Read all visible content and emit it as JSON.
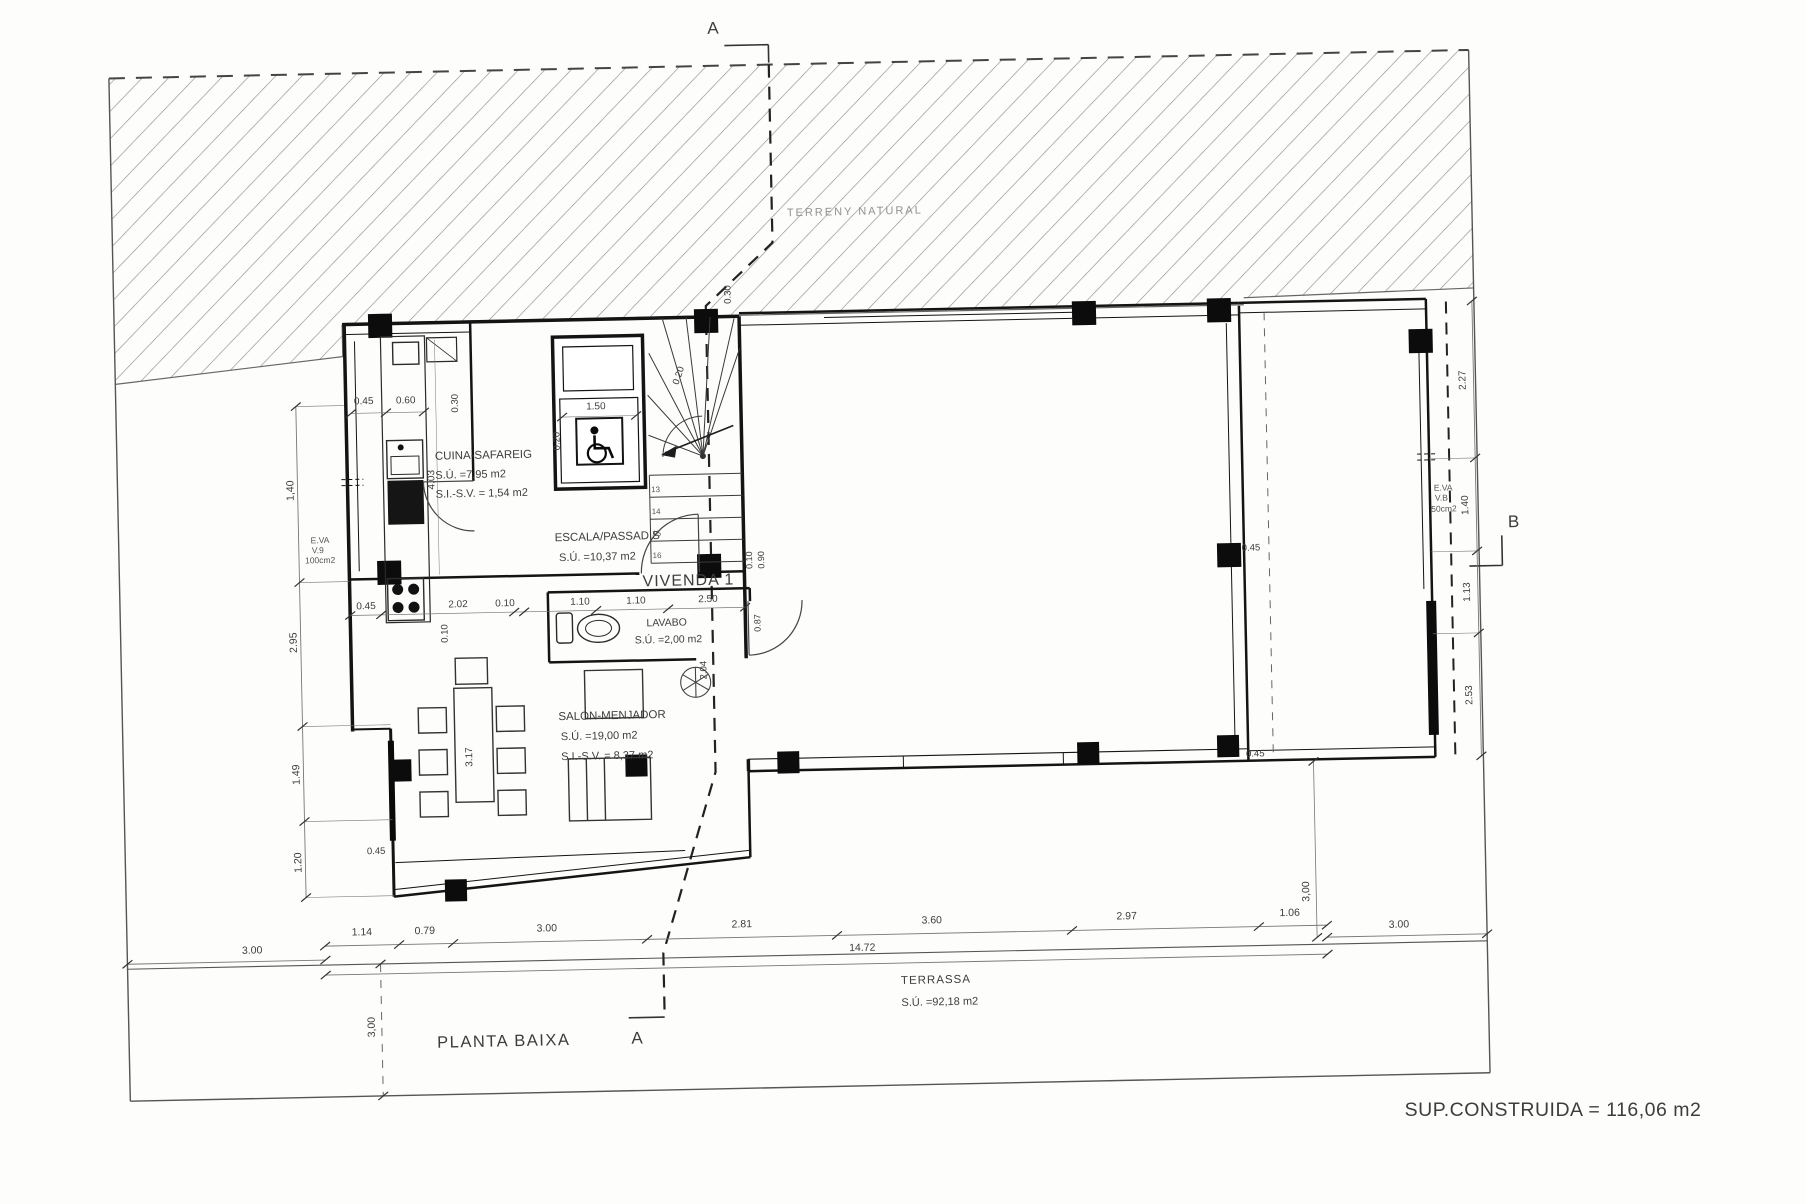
{
  "document": {
    "plan_title": "PLANTA BAIXA",
    "dwelling": "VIVENDA 1",
    "built_area": "SUP.CONSTRUIDA = 116,06 m2",
    "terrain_label": "TERRENY NATURAL",
    "section_markers": [
      "A",
      "B"
    ]
  },
  "rooms": [
    {
      "name": "CUINA-SAFAREIG",
      "areas": [
        "S.Ú. =7,95 m2",
        "S.I.-S.V. = 1,54 m2"
      ]
    },
    {
      "name": "ESCALA/PASSADIS",
      "areas": [
        "S.Ú. =10,37 m2"
      ]
    },
    {
      "name": "LAVABO",
      "areas": [
        "S.Ú. =2,00 m2"
      ]
    },
    {
      "name": "SALON-MENJADOR",
      "areas": [
        "S.Ú. =19,00 m2",
        "S.I.-S.V. = 8,37 m2"
      ]
    },
    {
      "name": "TERRASSA",
      "areas": [
        "S.Ú. =92,18 m2"
      ]
    }
  ],
  "labels": [
    {
      "id": "terrain-label",
      "text": "TERRENY NATURAL",
      "x": 795,
      "y": 214,
      "size": 11,
      "anchor": "start",
      "ls": 2,
      "color": "#909090"
    },
    {
      "id": "section-a-top",
      "text": "A",
      "x": 725,
      "y": 30,
      "size": 17
    },
    {
      "id": "section-a-bottom",
      "text": "A",
      "x": 628,
      "y": 1038,
      "size": 17
    },
    {
      "id": "section-b",
      "text": "B",
      "x": 1515,
      "y": 540,
      "size": 17
    },
    {
      "id": "room-cuina-name",
      "text": "CUINA-SAFAREIG",
      "x": 438,
      "y": 450,
      "size": 11.5,
      "anchor": "start"
    },
    {
      "id": "room-cuina-area1",
      "text": "S.Ú. =7,95 m2",
      "x": 438,
      "y": 469,
      "size": 11,
      "anchor": "start"
    },
    {
      "id": "room-cuina-area2",
      "text": "S.I.-S.V. = 1,54 m2",
      "x": 438,
      "y": 488,
      "size": 11,
      "anchor": "start"
    },
    {
      "id": "room-escala-name",
      "text": "ESCALA/PASSADIS",
      "x": 556,
      "y": 534,
      "size": 11.5,
      "anchor": "start"
    },
    {
      "id": "room-escala-area1",
      "text": "S.Ú. =10,37 m2",
      "x": 560,
      "y": 554,
      "size": 11,
      "anchor": "start"
    },
    {
      "id": "room-vivenda-name",
      "text": "VIVENDA 1",
      "x": 643,
      "y": 581,
      "size": 16,
      "anchor": "start",
      "ls": 1
    },
    {
      "id": "room-lavabo-name",
      "text": "LAVABO",
      "x": 646,
      "y": 621,
      "size": 10.5,
      "anchor": "start"
    },
    {
      "id": "room-lavabo-area1",
      "text": "S.Ú. =2,00 m2",
      "x": 634,
      "y": 638,
      "size": 10.5,
      "anchor": "start"
    },
    {
      "id": "room-salon-name",
      "text": "SALON-MENJADOR",
      "x": 556,
      "y": 713,
      "size": 11.5,
      "anchor": "start"
    },
    {
      "id": "room-salon-area1",
      "text": "S.Ú. =19,00 m2",
      "x": 558,
      "y": 733,
      "size": 11,
      "anchor": "start"
    },
    {
      "id": "room-salon-area2",
      "text": "S.I.-S.V. = 8,37 m2",
      "x": 558,
      "y": 753,
      "size": 11,
      "anchor": "start"
    },
    {
      "id": "room-terrassa-name",
      "text": "TERRASSA",
      "x": 893,
      "y": 984,
      "size": 11.5,
      "anchor": "start",
      "ls": 1
    },
    {
      "id": "room-terrassa-area1",
      "text": "S.Ú. =92,18 m2",
      "x": 893,
      "y": 1006,
      "size": 11,
      "anchor": "start"
    },
    {
      "id": "plan-title",
      "text": "PLANTA BAIXA",
      "x": 428,
      "y": 1038,
      "size": 16.5,
      "anchor": "start",
      "ls": 1.5
    },
    {
      "id": "built-area-note",
      "text": "SUP.CONSTRUIDA = 116,06 m2",
      "x": 1553,
      "y": 1116,
      "size": 19.5,
      "ls": 0.5,
      "fixed": true
    },
    {
      "id": "dim-bottom-1",
      "text": "1.14",
      "x": 355,
      "y": 924,
      "size": 10.5
    },
    {
      "id": "dim-bottom-2",
      "text": "0.79",
      "x": 418,
      "y": 924,
      "size": 10.5
    },
    {
      "id": "dim-bottom-3",
      "text": "3.00",
      "x": 540,
      "y": 924,
      "size": 10.5
    },
    {
      "id": "dim-bottom-4",
      "text": "2.81",
      "x": 735,
      "y": 924,
      "size": 10.5
    },
    {
      "id": "dim-bottom-5",
      "text": "3.60",
      "x": 925,
      "y": 924,
      "size": 10.5
    },
    {
      "id": "dim-bottom-6",
      "text": "2.97",
      "x": 1120,
      "y": 924,
      "size": 10.5
    },
    {
      "id": "dim-bottom-7",
      "text": "1.06",
      "x": 1283,
      "y": 924,
      "size": 10.5
    },
    {
      "id": "dim-bottom-total",
      "text": "14.72",
      "x": 855,
      "y": 950,
      "size": 10.5
    },
    {
      "id": "dim-left-300",
      "text": "3.00",
      "x": 245,
      "y": 940,
      "size": 10.5
    },
    {
      "id": "dim-right-300",
      "text": "3.00",
      "x": 1392,
      "y": 938,
      "size": 10.5
    },
    {
      "id": "dim-vert-300-left",
      "text": "3,00",
      "x": 366,
      "y": 1016,
      "rot": -90,
      "size": 10.5
    },
    {
      "id": "dim-vert-300-right",
      "text": "3,00",
      "x": 1303,
      "y": 900,
      "rot": -90,
      "size": 10.5
    },
    {
      "id": "dim-leftchain-1",
      "text": "1,40",
      "x": 296,
      "y": 478,
      "rot": -90,
      "size": 10.5
    },
    {
      "id": "dim-leftchain-2",
      "text": "2.95",
      "x": 296,
      "y": 630,
      "rot": -90,
      "size": 10.5
    },
    {
      "id": "dim-leftchain-3",
      "text": "1.49",
      "x": 296,
      "y": 762,
      "rot": -90,
      "size": 10.5
    },
    {
      "id": "dim-leftchain-4",
      "text": "1.20",
      "x": 296,
      "y": 850,
      "rot": -90,
      "size": 10.5
    },
    {
      "id": "dim-045-topleft",
      "text": "0.45",
      "x": 368,
      "y": 393,
      "size": 10
    },
    {
      "id": "dim-060-topleft",
      "text": "0.60",
      "x": 410,
      "y": 393,
      "size": 10
    },
    {
      "id": "dim-030-kitchen",
      "text": "0.30",
      "x": 462,
      "y": 394,
      "rot": -90,
      "size": 9.5
    },
    {
      "id": "dim-403-kitchen",
      "text": "4.03",
      "x": 437,
      "y": 470,
      "rot": -90,
      "size": 10
    },
    {
      "id": "dim-020-elevator",
      "text": "0.20",
      "x": 563,
      "y": 434,
      "rot": -90,
      "size": 9.5
    },
    {
      "id": "dim-150-elevator",
      "text": "1.50",
      "x": 600,
      "y": 403,
      "size": 10
    },
    {
      "id": "dim-020-stairs",
      "text": "0.20",
      "x": 686,
      "y": 372,
      "rot": -70,
      "size": 9.5
    },
    {
      "id": "dim-030-top",
      "text": "0.30",
      "x": 737,
      "y": 291,
      "rot": -90,
      "size": 9.5
    },
    {
      "id": "dim-row-045",
      "text": "0.45",
      "x": 366,
      "y": 598,
      "size": 10
    },
    {
      "id": "dim-row-202",
      "text": "2.02",
      "x": 458,
      "y": 598,
      "size": 10
    },
    {
      "id": "dim-row-010",
      "text": "0.10",
      "x": 505,
      "y": 598,
      "size": 10
    },
    {
      "id": "dim-row-110a",
      "text": "1.10",
      "x": 580,
      "y": 598,
      "size": 10
    },
    {
      "id": "dim-row-110b",
      "text": "1.10",
      "x": 636,
      "y": 598,
      "size": 10
    },
    {
      "id": "dim-row-250",
      "text": "2.50",
      "x": 708,
      "y": 598,
      "size": 10
    },
    {
      "id": "dim-317-table",
      "text": "3.17",
      "x": 469,
      "y": 748,
      "rot": -90,
      "size": 10
    },
    {
      "id": "dim-010-salon",
      "text": "0.10",
      "x": 447,
      "y": 624,
      "rot": -90,
      "size": 9.5
    },
    {
      "id": "dim-010-hall",
      "text": "0.10",
      "x": 753,
      "y": 557,
      "rot": -90,
      "size": 9
    },
    {
      "id": "dim-090-hall",
      "text": "0.90",
      "x": 765,
      "y": 557,
      "rot": -90,
      "size": 9
    },
    {
      "id": "dim-087-door",
      "text": "0.87",
      "x": 760,
      "y": 620,
      "rot": -90,
      "size": 9
    },
    {
      "id": "dim-204-door",
      "text": "2.04",
      "x": 705,
      "y": 666,
      "rot": -90,
      "size": 9.5
    },
    {
      "id": "dim-045-bottomleft",
      "text": "0.45",
      "x": 371,
      "y": 843,
      "size": 9.5
    },
    {
      "id": "dim-045-right1",
      "text": "0.45",
      "x": 1252,
      "y": 558,
      "size": 9.5
    },
    {
      "id": "dim-045-right2",
      "text": "0.45",
      "x": 1252,
      "y": 764,
      "size": 9.5
    },
    {
      "id": "dim-rightchain-1",
      "text": "2.27",
      "x": 1470,
      "y": 392,
      "rot": -90,
      "size": 10
    },
    {
      "id": "dim-rightchain-2",
      "text": "1.40",
      "x": 1470,
      "y": 517,
      "rot": -90,
      "size": 10
    },
    {
      "id": "dim-rightchain-3",
      "text": "1.13",
      "x": 1470,
      "y": 604,
      "rot": -90,
      "size": 10
    },
    {
      "id": "dim-rightchain-4",
      "text": "2.53",
      "x": 1470,
      "y": 707,
      "rot": -90,
      "size": 10
    },
    {
      "id": "vent-left-1",
      "text": "E.VA",
      "x": 312,
      "y": 531,
      "size": 8.5,
      "anchor": "start",
      "color": "#555555"
    },
    {
      "id": "vent-left-2",
      "text": "V.9",
      "x": 313,
      "y": 541,
      "size": 8.5,
      "anchor": "start",
      "color": "#555555"
    },
    {
      "id": "vent-left-3",
      "text": "100cm2",
      "x": 306,
      "y": 551,
      "size": 8.5,
      "anchor": "start",
      "color": "#555555"
    },
    {
      "id": "vent-right-1",
      "text": "E.VA",
      "x": 1436,
      "y": 502,
      "size": 8.5,
      "anchor": "start",
      "color": "#555555"
    },
    {
      "id": "vent-right-2",
      "text": "V.B",
      "x": 1437,
      "y": 512,
      "size": 8.5,
      "anchor": "start",
      "color": "#555555"
    },
    {
      "id": "vent-right-3",
      "text": "50cm2",
      "x": 1433,
      "y": 523,
      "size": 8.5,
      "anchor": "start",
      "color": "#555555"
    },
    {
      "id": "stair-step-13",
      "text": "13",
      "x": 658,
      "y": 487,
      "size": 8,
      "color": "#555555"
    },
    {
      "id": "stair-step-14",
      "text": "14",
      "x": 658,
      "y": 509,
      "size": 8,
      "color": "#555555"
    },
    {
      "id": "stair-step-15",
      "text": "15",
      "x": 658,
      "y": 531,
      "size": 8,
      "color": "#555555"
    },
    {
      "id": "stair-step-16",
      "text": "16",
      "x": 658,
      "y": 553,
      "size": 8,
      "color": "#555555"
    }
  ]
}
